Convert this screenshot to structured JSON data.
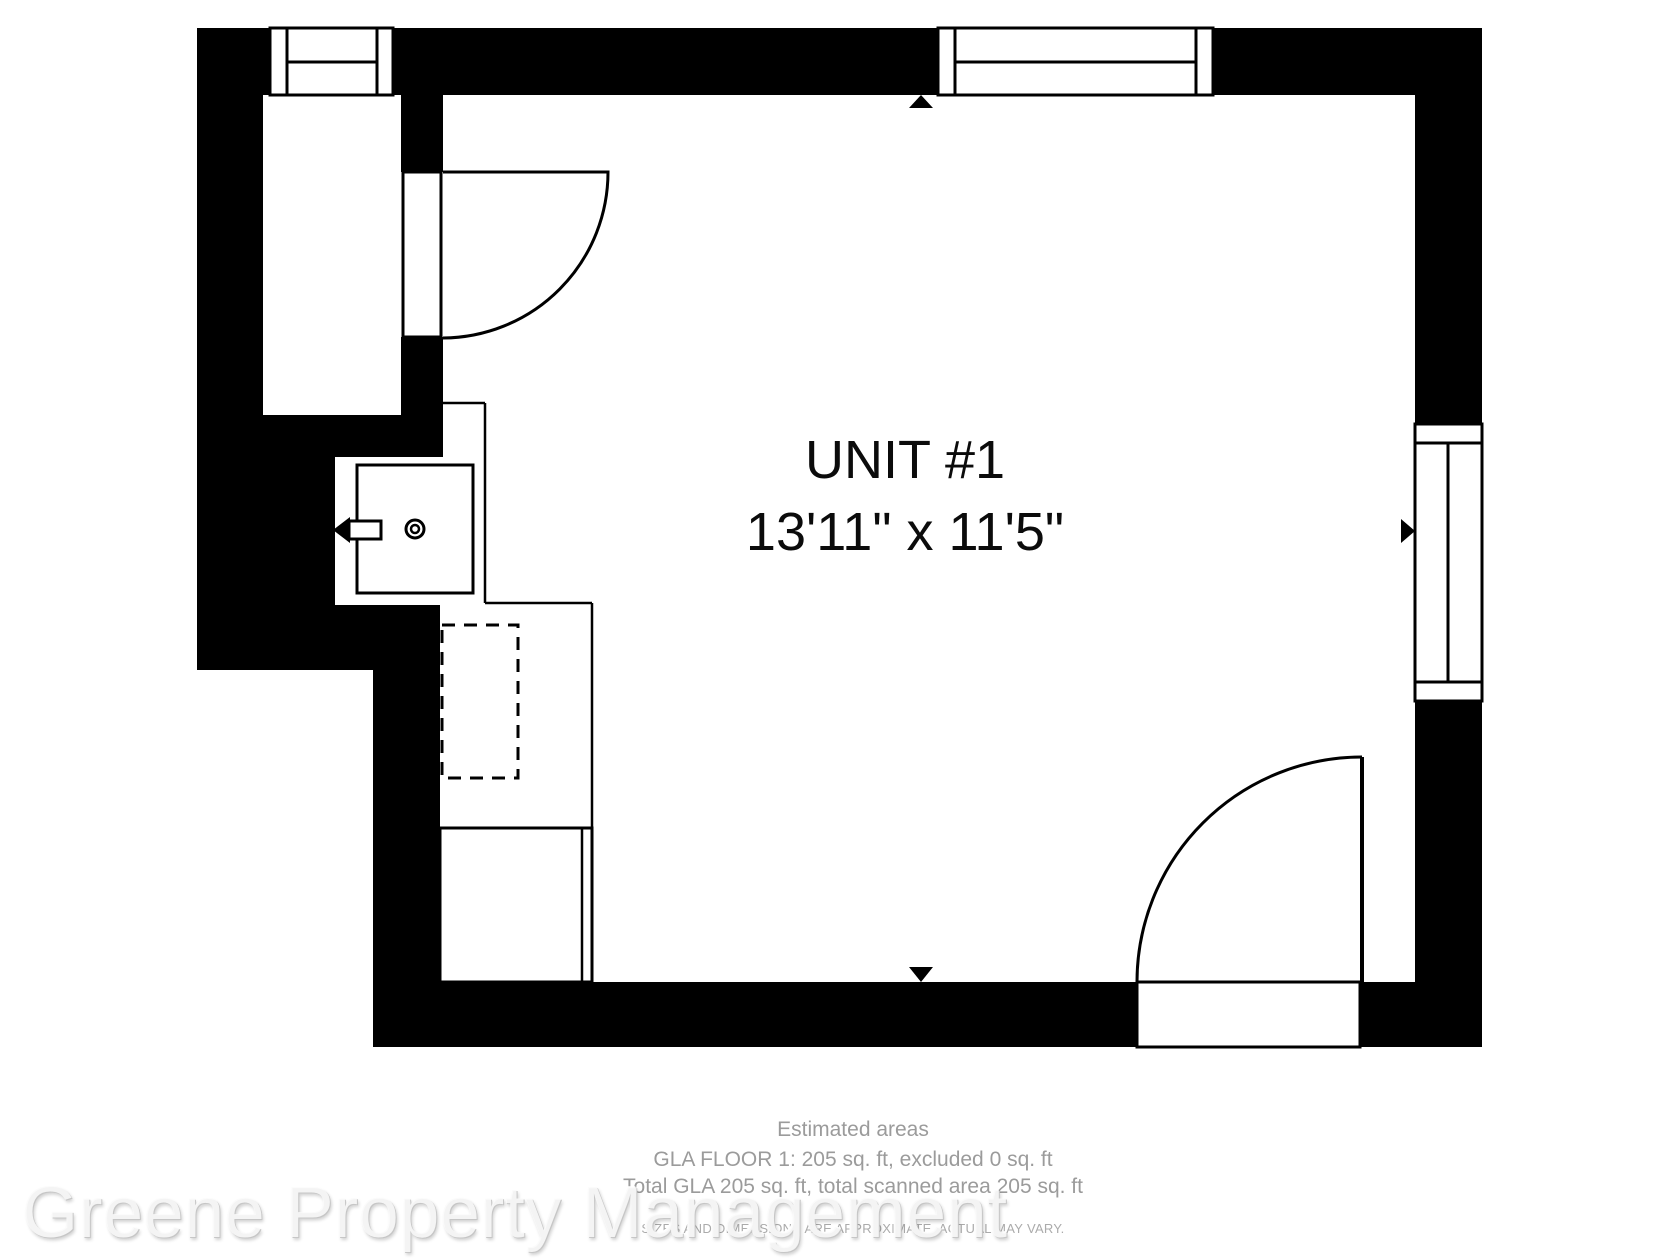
{
  "plan": {
    "unit_label": "UNIT #1",
    "unit_dimensions": "13'11\" x 11'5\""
  },
  "footer": {
    "estimated_areas": "Estimated areas",
    "gla_floor": "GLA FLOOR 1: 205 sq. ft, excluded 0 sq. ft",
    "total_gla": "Total GLA 205 sq. ft, total scanned area 205 sq. ft",
    "disclaimer": "SIZES AND DIMENSIONS ARE APPROXIMATE, ACTUAL MAY VARY."
  },
  "watermark": {
    "text": "Greene Property Management"
  },
  "colors": {
    "wall": "#000000",
    "background": "#ffffff",
    "label_text": "#0b0b0b",
    "footer_text": "#9b9b9b",
    "disclaimer_text": "#ababab",
    "watermark_text": "#fafafa"
  }
}
